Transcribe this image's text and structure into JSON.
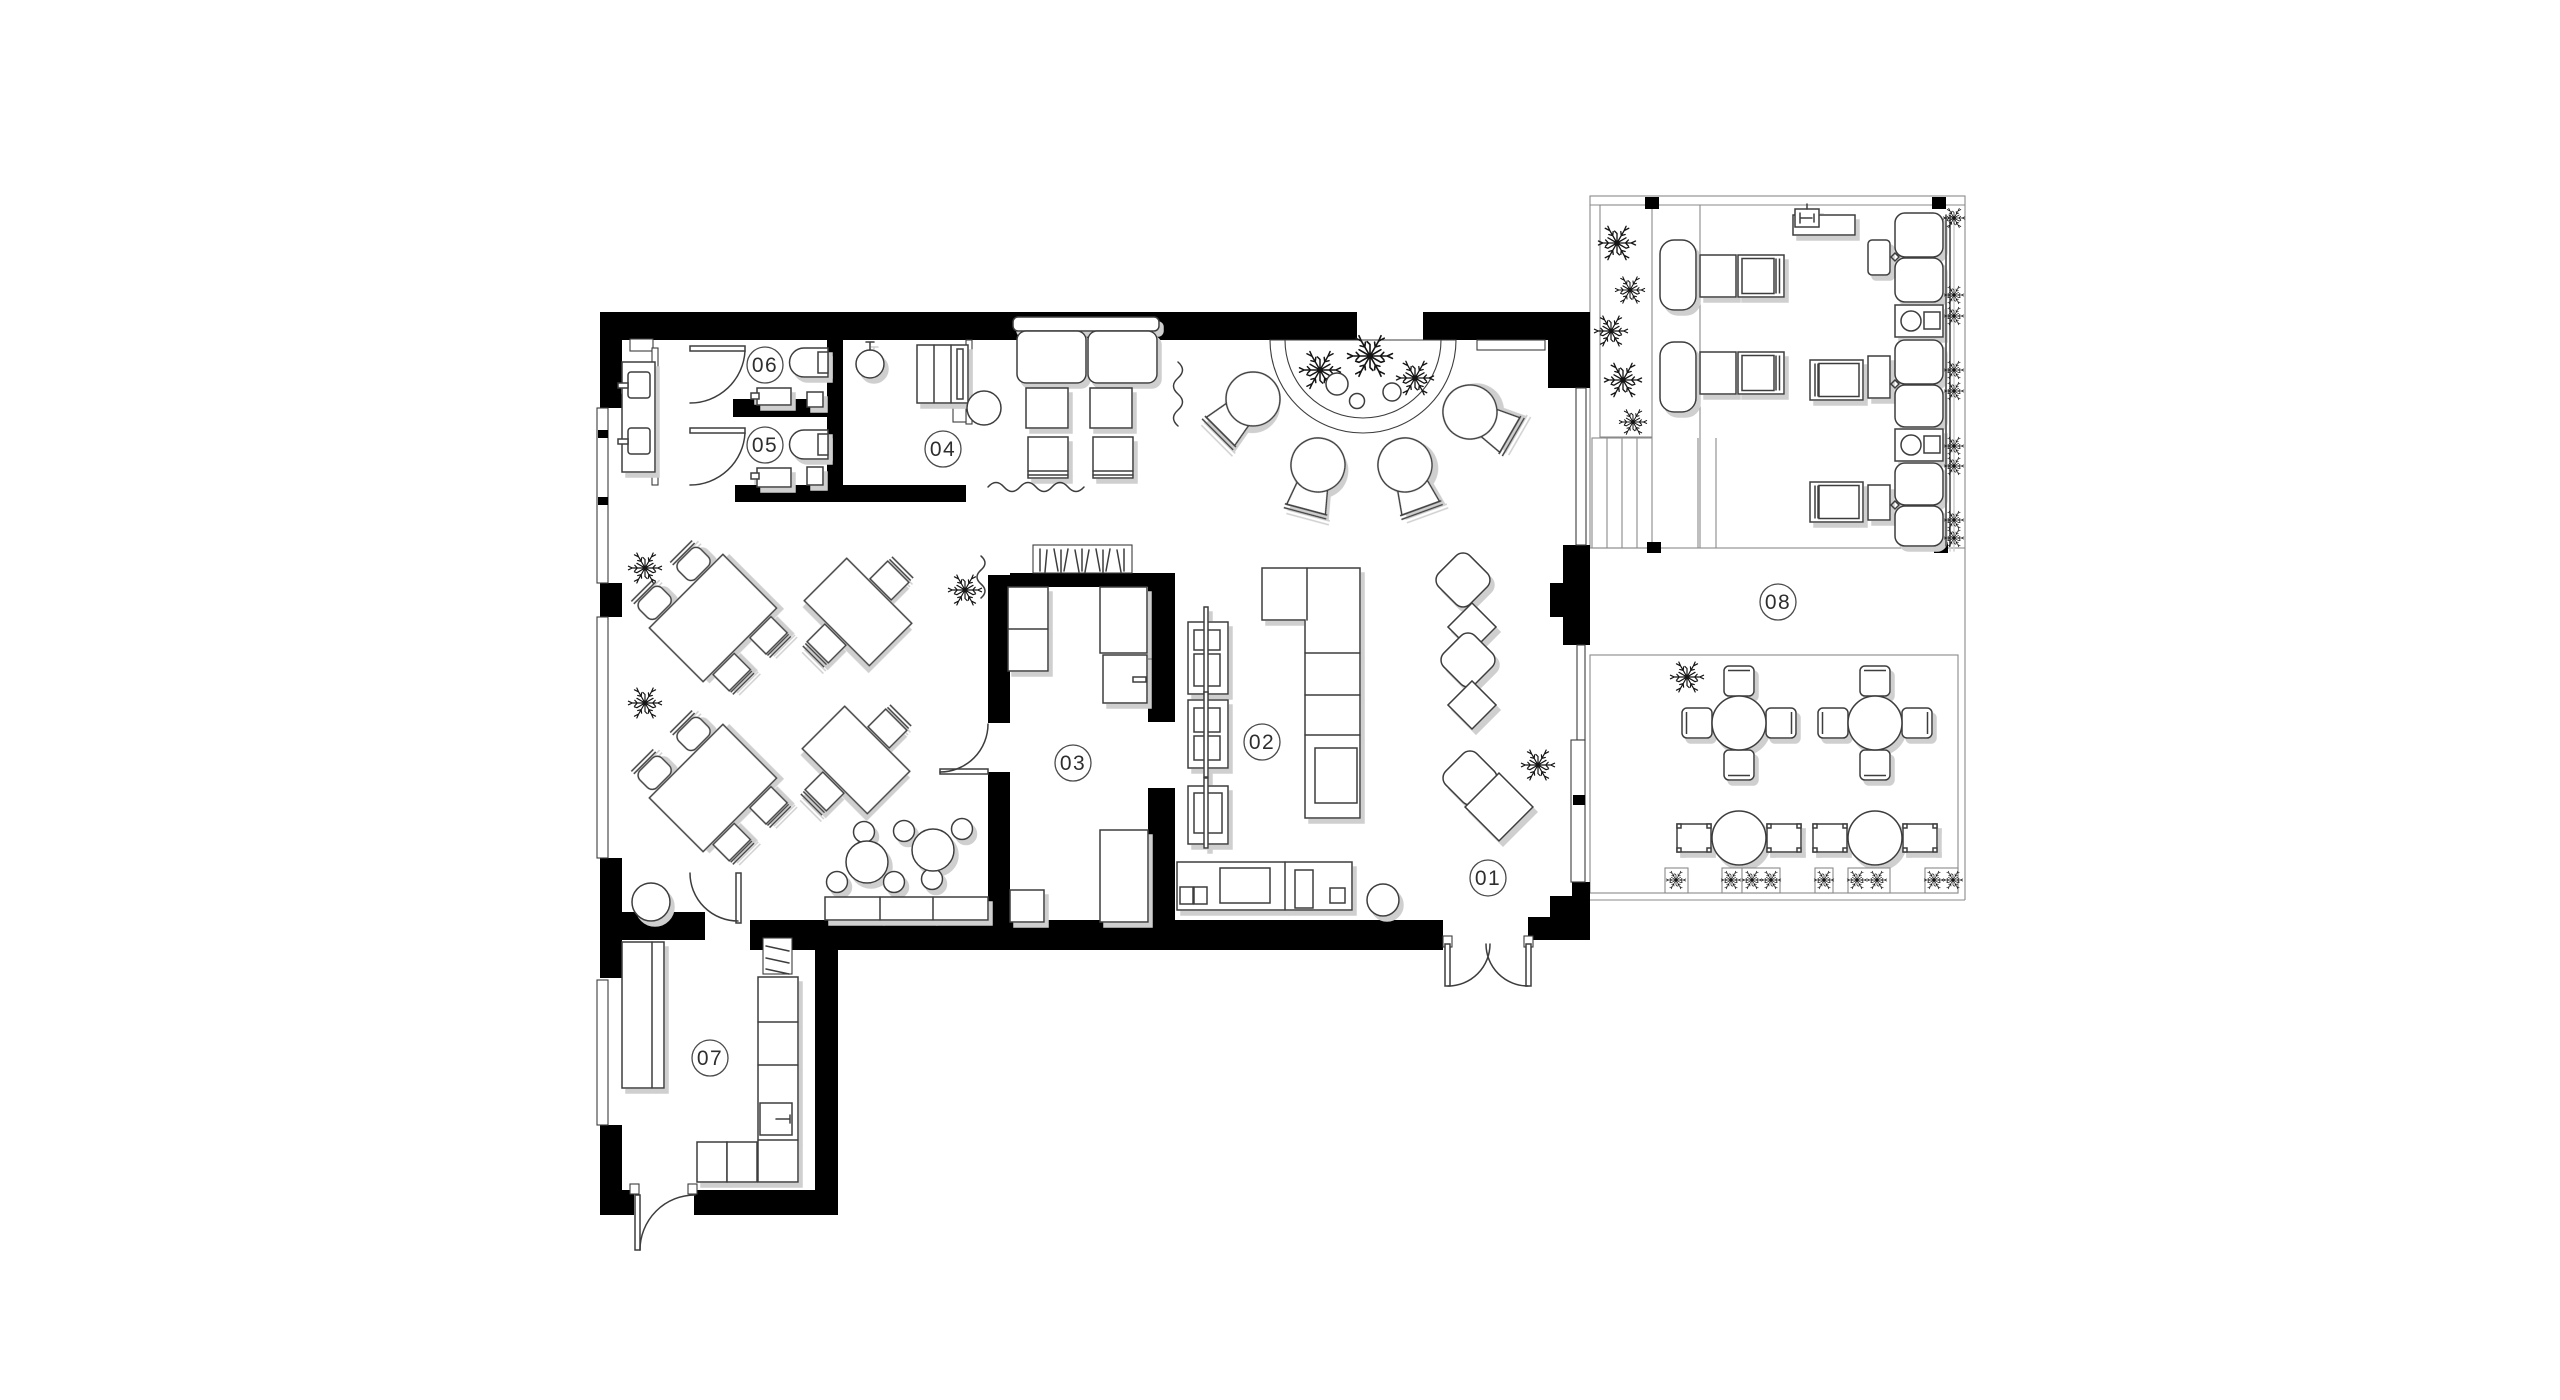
{
  "plan": {
    "rooms": [
      {
        "label": "01"
      },
      {
        "label": "02"
      },
      {
        "label": "03"
      },
      {
        "label": "04"
      },
      {
        "label": "05"
      },
      {
        "label": "06"
      },
      {
        "label": "07"
      },
      {
        "label": "08"
      }
    ]
  },
  "colors": {
    "wall": "#000000",
    "line": "#3d3d3d",
    "thin": "#8a8a8a",
    "shadow": "#cfcfcf",
    "background": "#ffffff",
    "label-text": "#2e2e2e",
    "label-ring": "#4a4a4a"
  }
}
